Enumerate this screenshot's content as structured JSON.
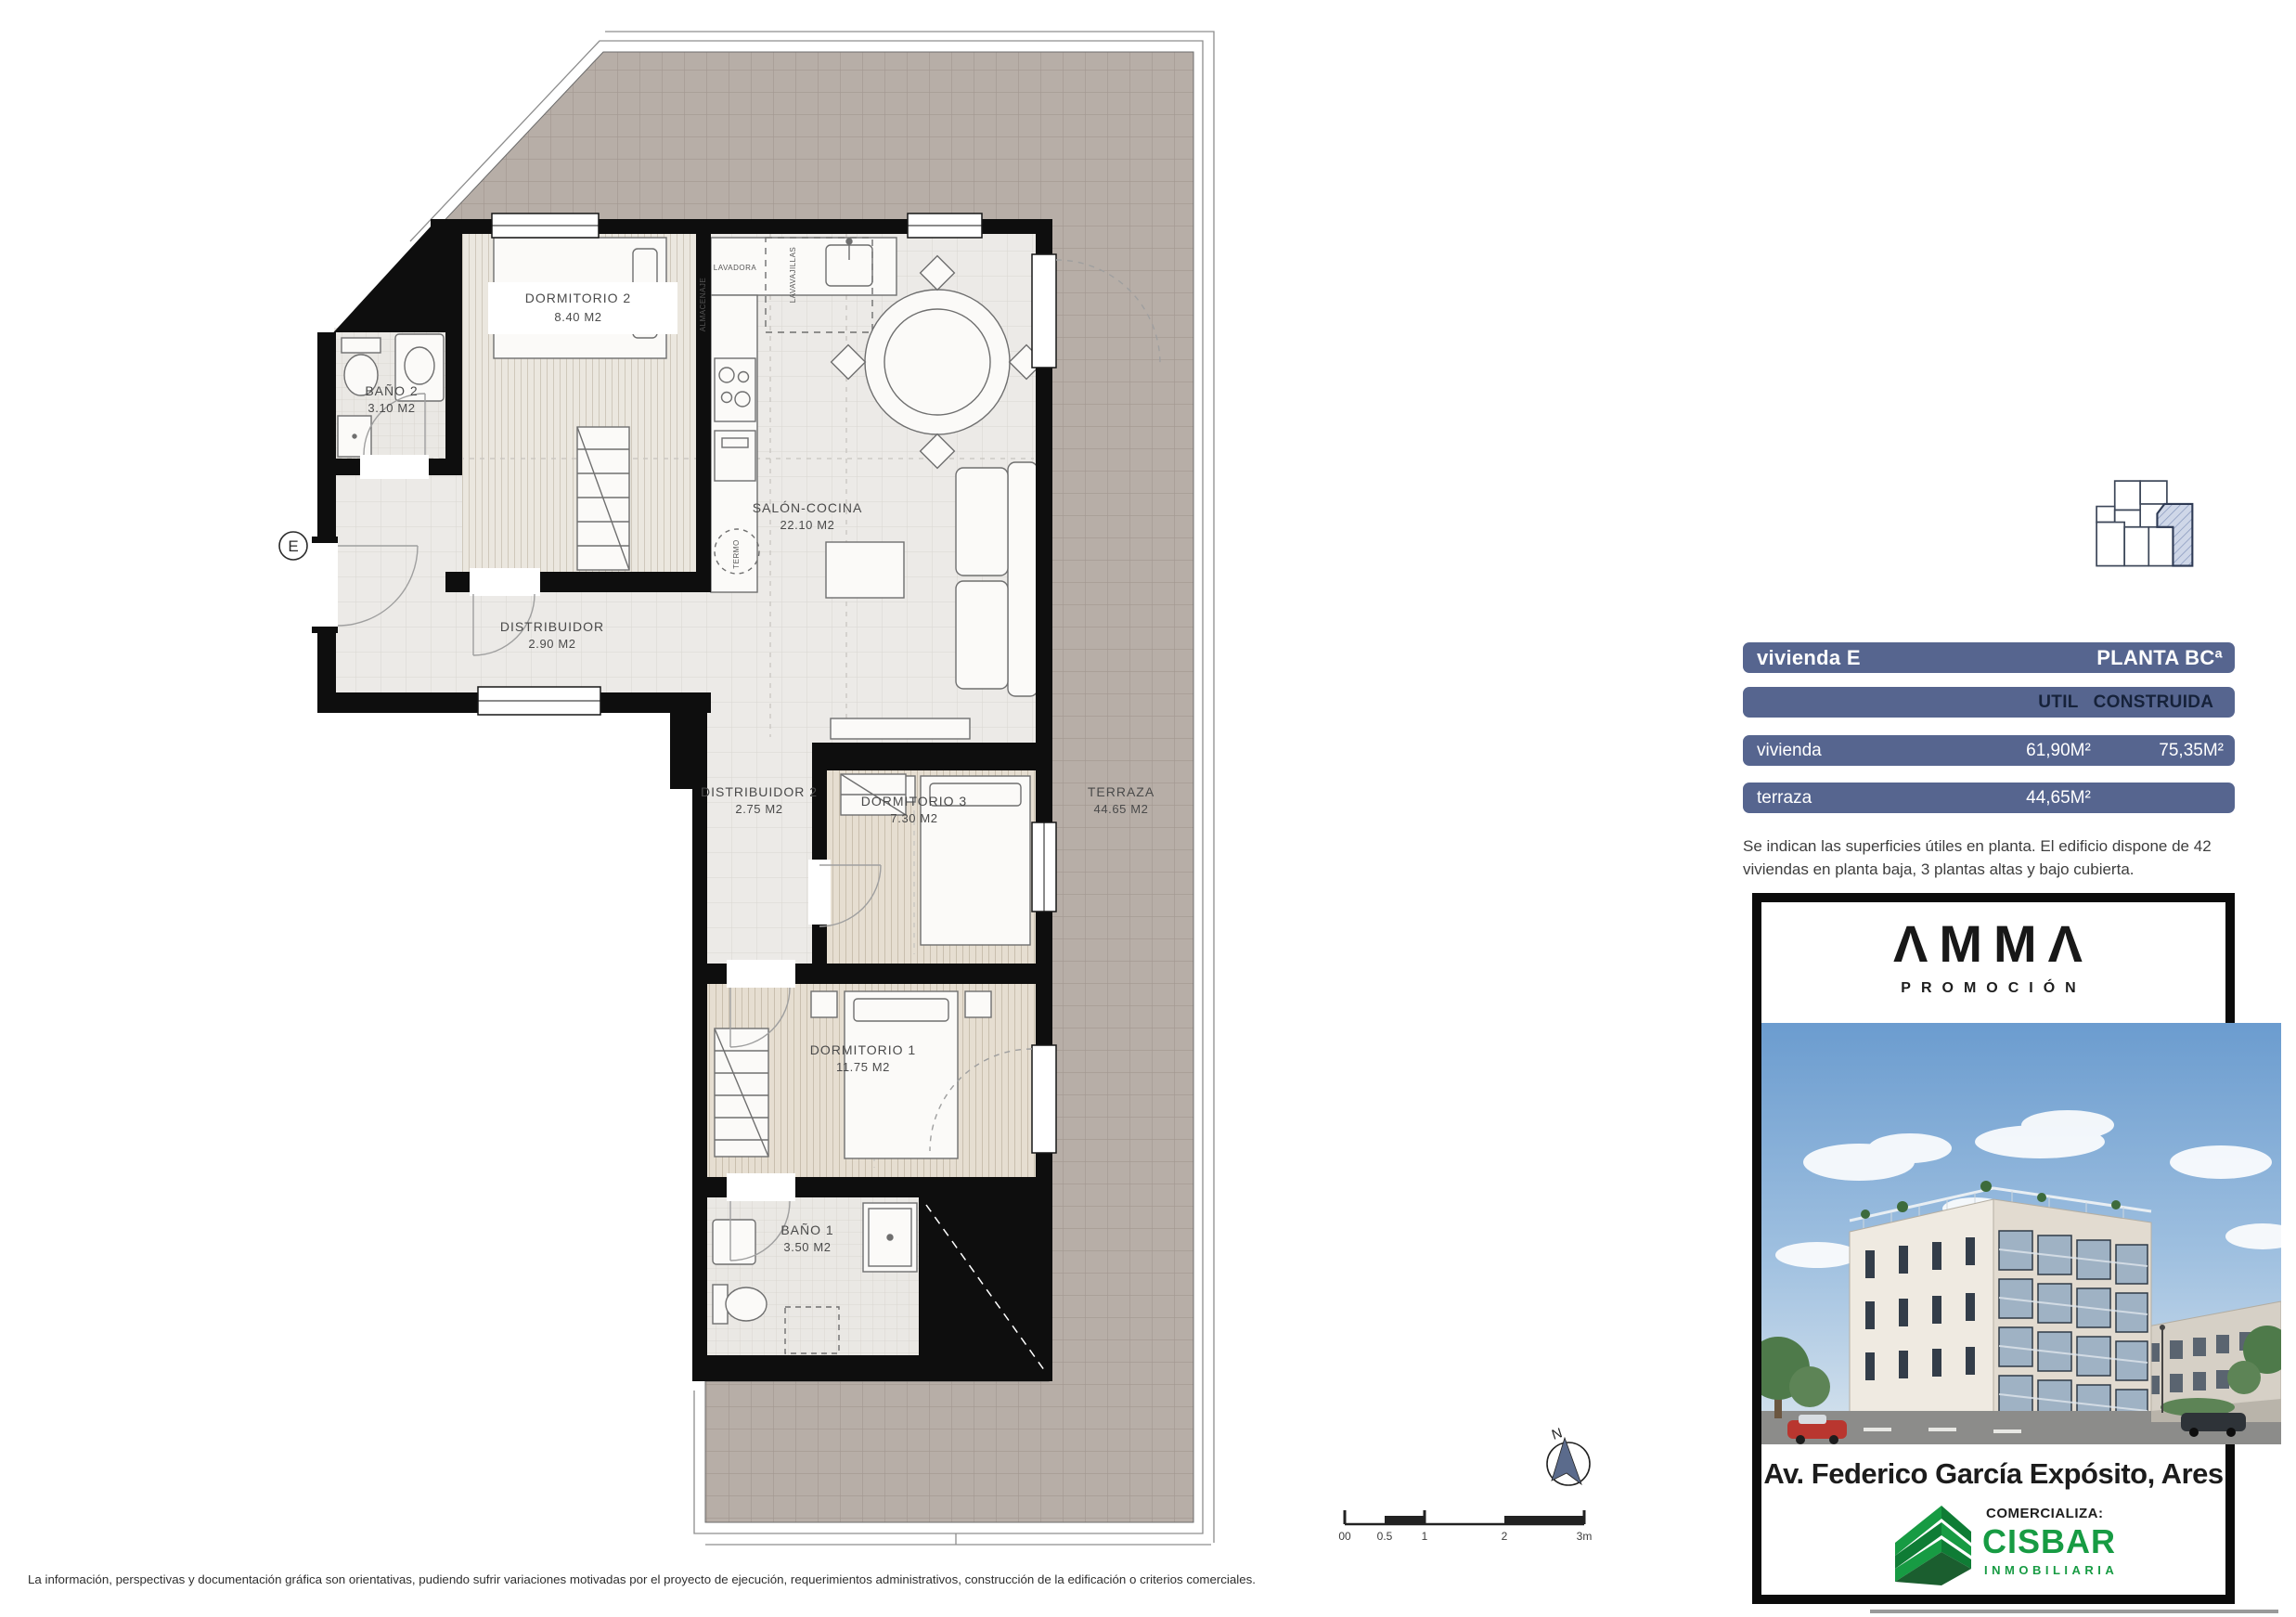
{
  "plan": {
    "entrance_label": "E",
    "rooms": {
      "dormitorio2": {
        "name": "DORMITORIO 2",
        "area": "8.40 M2"
      },
      "bano2": {
        "name": "BAÑO 2",
        "area": "3.10 M2"
      },
      "distribuidor": {
        "name": "DISTRIBUIDOR",
        "area": "2.90 M2"
      },
      "salon": {
        "name": "SALÓN-COCINA",
        "area": "22.10 M2"
      },
      "distribuidor2": {
        "name": "DISTRIBUIDOR 2",
        "area": "2.75 M2"
      },
      "dormitorio3": {
        "name": "DORMITORIO 3",
        "area": "7.30 M2"
      },
      "terraza": {
        "name": "TERRAZA",
        "area": "44.65 M2"
      },
      "dormitorio1": {
        "name": "DORMITORIO 1",
        "area": "11.75 M2"
      },
      "bano1": {
        "name": "BAÑO 1",
        "area": "3.50 M2"
      }
    },
    "fixtures": {
      "lavadora": "LAVADORA",
      "lavavajillas": "LAVAVAJILLAS",
      "almacenaje": "ALMACENAJE",
      "termo": "TERMO"
    },
    "north_label": "N",
    "scale_ticks": [
      "00",
      "0.5",
      "1",
      "2",
      "3m"
    ]
  },
  "panel": {
    "unit_label": "vivienda E",
    "floor_label": "PLANTA BCª",
    "columns": {
      "util": "UTIL",
      "construida": "CONSTRUIDA"
    },
    "rows": [
      {
        "label": "vivienda",
        "util": "61,90M²",
        "construida": "75,35M²"
      },
      {
        "label": "terraza",
        "util": "44,65M²",
        "construida": ""
      }
    ],
    "note": "Se indican las superficies útiles en planta. El edificio dispone de 42 viviendas en planta baja, 3 plantas altas y bajo cubierta.",
    "brand_name": "ΛMMΛ",
    "brand_subtitle": "PROMOCIÓN",
    "address": "Av. Federico García Expósito, Ares",
    "marketer_label": "COMERCIALIZA:",
    "marketer_name": "CISBAR",
    "marketer_subtitle": "INMOBILIARIA"
  },
  "footer": {
    "disclaimer": "La información, perspectivas y documentación gráfica son orientativas, pudiendo sufrir variaciones motivadas por el proyecto de ejecución, requerimientos administrativos, construcción de la edificación o criterios comerciales."
  },
  "colors": {
    "bar_blue": "#56658f",
    "hatch_blue": "#cfd7e8",
    "cisbar_green": "#179b43"
  }
}
